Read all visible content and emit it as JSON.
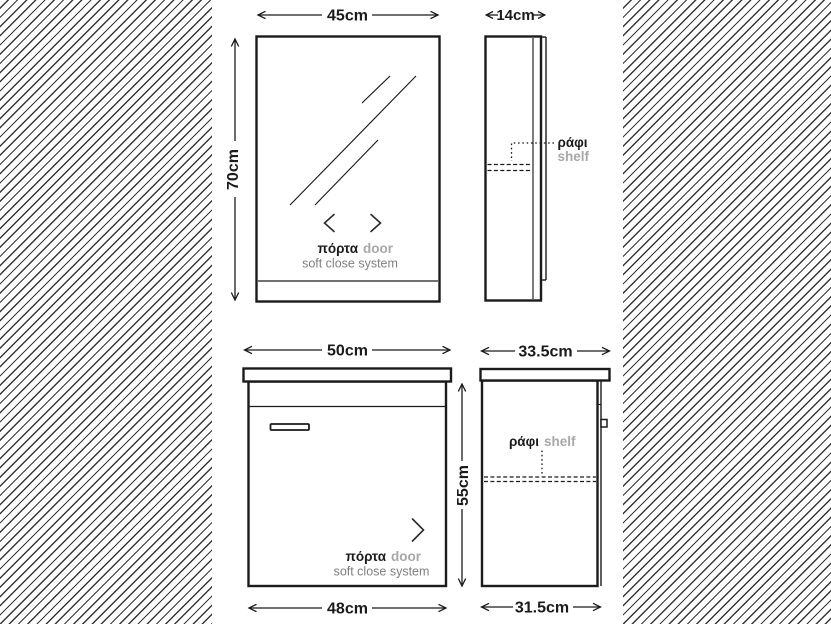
{
  "colors": {
    "line": "#1b1b1b",
    "label_gray": "#a8a8a8",
    "note_gray": "#7f7f7f",
    "hatch_line": "#383838",
    "background": "#ffffff"
  },
  "views": {
    "mirror_front": {
      "width": "45cm",
      "height": "70cm",
      "door_gr": "πόρτα",
      "door_en": "door",
      "note": "soft close system"
    },
    "mirror_side": {
      "depth": "14cm",
      "shelf_gr": "ράφι",
      "shelf_en": "shelf"
    },
    "vanity_front": {
      "width_top": "50cm",
      "height": "55cm",
      "width_bottom": "48cm",
      "door_gr": "πόρτα",
      "door_en": "door",
      "note": "soft close system"
    },
    "vanity_side": {
      "depth_top": "33.5cm",
      "depth_bottom": "31.5cm",
      "shelf_gr": "ράφι",
      "shelf_en": "shelf"
    }
  }
}
